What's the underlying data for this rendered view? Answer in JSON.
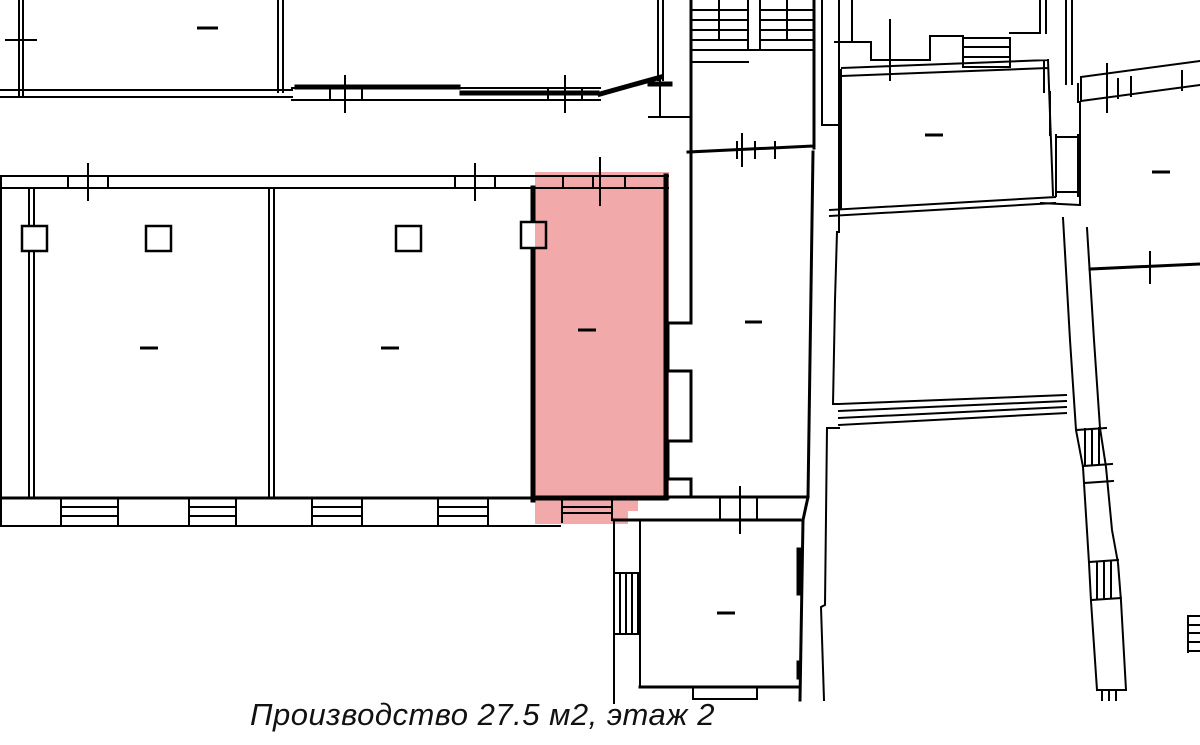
{
  "plan": {
    "caption": "Производство 27.5 м2, этаж 2",
    "highlight_color": "#f2a6a6",
    "wall_color": "#000000",
    "background_color": "#ffffff",
    "highlighted_room": {
      "status": "highlighted",
      "type": "production-space"
    }
  }
}
